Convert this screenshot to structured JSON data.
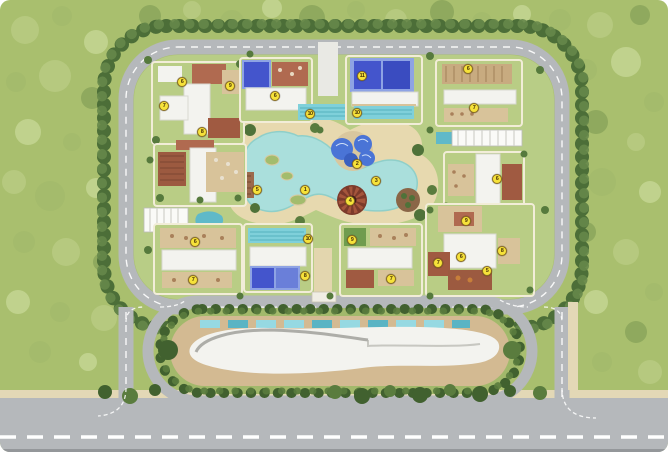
{
  "colors": {
    "grass": "#a9bf6e",
    "compound_green": "#b8cd86",
    "road": "#b5b8bb",
    "road_line": "#ffffff",
    "sidewalk": "#e3d8b6",
    "water": "#aadfdc",
    "sand": "#e7d9af",
    "lap_pool": "#7fd0da",
    "pool_blue": "#4455cc",
    "pool_frame": "#8ea3e4",
    "building_white": "#f3f3ef",
    "deck_tan": "#d8c39a",
    "deck_red": "#a05a41",
    "deck_rust": "#b06a50",
    "hedge_dark": "#4c6e38",
    "hedge_light": "#66874a",
    "palm_dark": "#41612f",
    "tree_light": "#b6c97f",
    "marker_fill": "#f6e23a",
    "marker_border": "#8a6d1f",
    "marker_text": "#4a3306"
  },
  "markers": [
    {
      "label": "1",
      "x": 305,
      "y": 190
    },
    {
      "label": "2",
      "x": 357,
      "y": 164
    },
    {
      "label": "3",
      "x": 376,
      "y": 181
    },
    {
      "label": "4",
      "x": 350,
      "y": 201
    },
    {
      "label": "5",
      "x": 257,
      "y": 190
    },
    {
      "label": "6",
      "x": 182,
      "y": 82
    },
    {
      "label": "7",
      "x": 164,
      "y": 106
    },
    {
      "label": "8",
      "x": 202,
      "y": 132
    },
    {
      "label": "9",
      "x": 230,
      "y": 86
    },
    {
      "label": "6",
      "x": 275,
      "y": 96
    },
    {
      "label": "10",
      "x": 310,
      "y": 114
    },
    {
      "label": "11",
      "x": 362,
      "y": 76
    },
    {
      "label": "10",
      "x": 357,
      "y": 113
    },
    {
      "label": "6",
      "x": 468,
      "y": 69
    },
    {
      "label": "7",
      "x": 474,
      "y": 108
    },
    {
      "label": "6",
      "x": 497,
      "y": 179
    },
    {
      "label": "9",
      "x": 466,
      "y": 221
    },
    {
      "label": "6",
      "x": 461,
      "y": 257
    },
    {
      "label": "7",
      "x": 438,
      "y": 263
    },
    {
      "label": "8",
      "x": 502,
      "y": 251
    },
    {
      "label": "5",
      "x": 487,
      "y": 271
    },
    {
      "label": "6",
      "x": 195,
      "y": 242
    },
    {
      "label": "7",
      "x": 193,
      "y": 280
    },
    {
      "label": "10",
      "x": 308,
      "y": 239
    },
    {
      "label": "8",
      "x": 305,
      "y": 276
    },
    {
      "label": "9",
      "x": 352,
      "y": 240
    },
    {
      "label": "7",
      "x": 391,
      "y": 279
    }
  ]
}
